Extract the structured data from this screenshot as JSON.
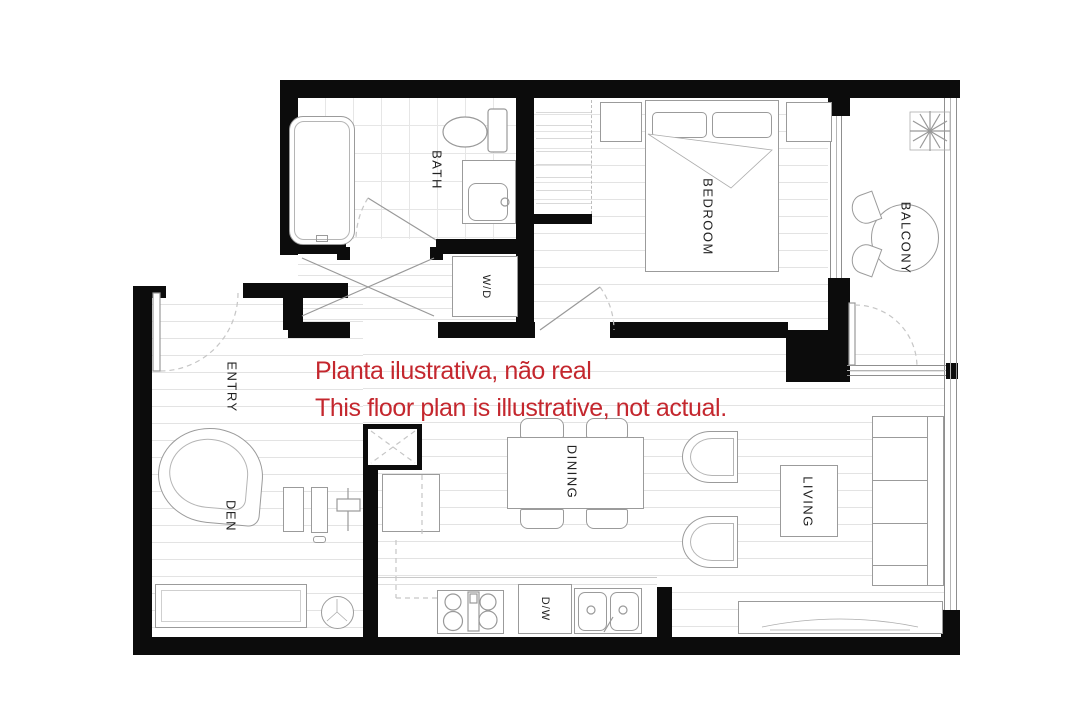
{
  "annotation": {
    "line1": "Planta ilustrativa, não real",
    "line2": "This floor plan is illustrative, not actual."
  },
  "labels": {
    "bath": "BATH",
    "bedroom": "BEDROOM",
    "balcony": "BALCONY",
    "washer_dryer": "W/D",
    "entry": "ENTRY",
    "den": "DEN",
    "dining": "DINING",
    "living": "LIVING",
    "dishwasher": "D/W"
  },
  "colors": {
    "annotation_red": "#c4272e",
    "wall_black": "#0c0c0c"
  }
}
